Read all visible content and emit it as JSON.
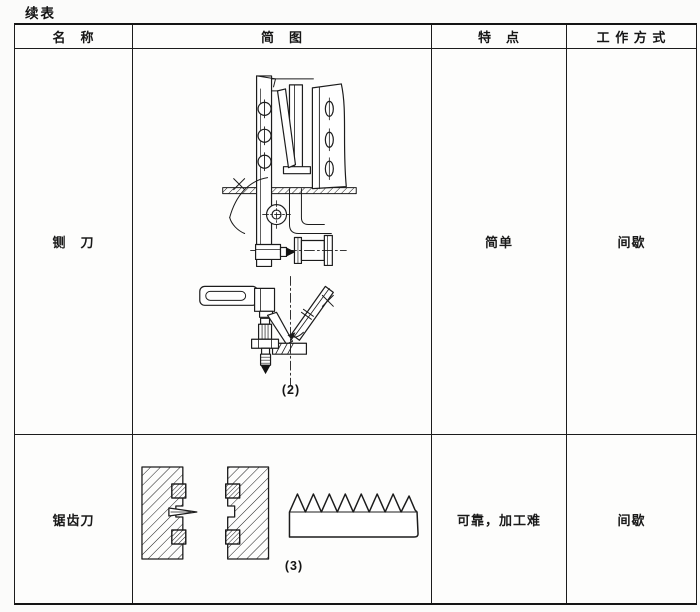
{
  "page": {
    "continued_label": "续表"
  },
  "table": {
    "headers": {
      "name": "名　称",
      "diagram": "简　图",
      "features": "特　点",
      "working_mode": "工 作 方 式"
    },
    "rows": [
      {
        "name": "铡　刀",
        "diagram_icon": "guillotine-cutter-mechanism-diagram",
        "diagram_label": "(2)",
        "features": "简单",
        "working_mode": "间歇"
      },
      {
        "name": "锯齿刀",
        "diagram_icon": "serrated-blade-diagram",
        "diagram_label": "(3)",
        "features": "可靠，加工难",
        "working_mode": "间歇"
      }
    ]
  }
}
